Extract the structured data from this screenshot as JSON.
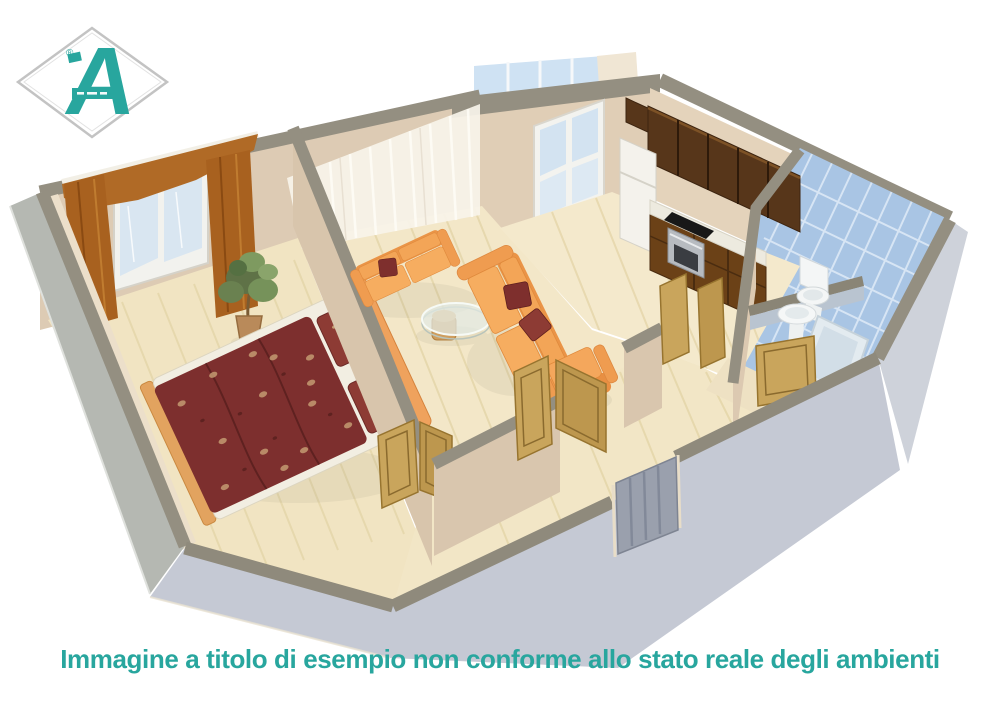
{
  "canvas": {
    "width": 1000,
    "height": 707,
    "background": "#ffffff"
  },
  "logo": {
    "letter": "A",
    "registered_mark": "®",
    "accent_color": "#28a69e",
    "diamond_outline_color": "#c3c3c3"
  },
  "caption": {
    "text": "Immagine a titolo di esempio non conforme allo stato reale degli ambienti",
    "color": "#28a69e"
  },
  "scene": {
    "type": "3d-floor-plan-render",
    "style": "cutaway axonometric apartment, low gray outer walls, beige inner walls, light wood floors",
    "rooms": [
      {
        "name": "bedroom",
        "contents": [
          "double bed with dark red floral duvet",
          "two red pillows",
          "orange headboard",
          "potted plant",
          "window with rust curtains"
        ]
      },
      {
        "name": "living-room",
        "contents": [
          "two orange sofas",
          "dark red cushions",
          "round glass coffee table",
          "orange armchair",
          "sheer white curtains",
          "balcony glazing"
        ]
      },
      {
        "name": "kitchen",
        "contents": [
          "dark wood wall cabinets",
          "white fridge",
          "counter with black cooktop and oven",
          "window"
        ]
      },
      {
        "name": "bathroom",
        "contents": [
          "light blue wall tiles",
          "toilet",
          "washbasin",
          "bathtub",
          "low partition wall"
        ]
      },
      {
        "name": "hallway",
        "contents": [
          "open light-wood doors",
          "gray paneled entry door"
        ]
      }
    ],
    "palette": {
      "wall_top": "#948f81",
      "outer_wall": "#c5c9d4",
      "inner_wall": "#ddcbb4",
      "floor": "#f1e4c2",
      "tile_blue": "#a9c5e4",
      "sofa_orange": "#f2a257",
      "duvet_red": "#7d2f2e",
      "door_wood": "#c9a55c",
      "accent_teal": "#28a69e"
    }
  }
}
